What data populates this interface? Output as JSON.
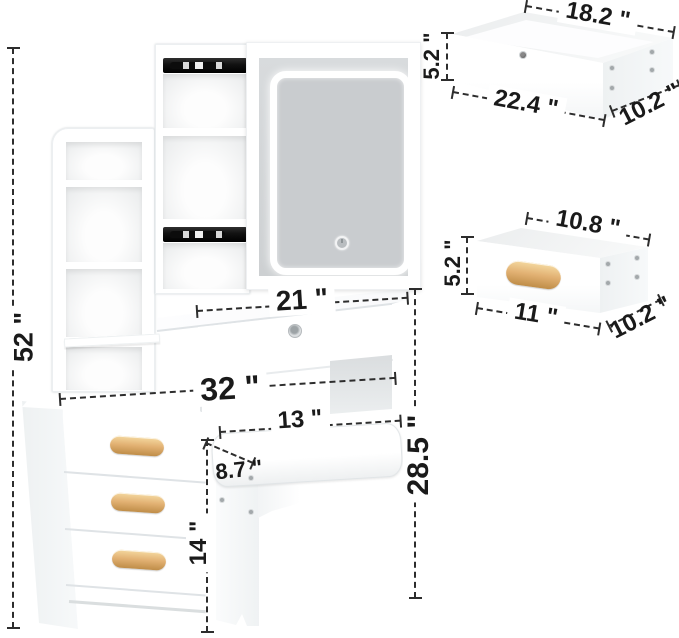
{
  "diagram": {
    "title": "vanity-set-dimension-diagram",
    "accent_colors": {
      "wood_handle": "#e2b173",
      "slide_rail": "#161616",
      "dimension_line": "#2d2d2d",
      "mirror_glass": "#c9cccf",
      "led_ring": "#ffffff"
    },
    "main_unit": {
      "total_height": "52 \"",
      "desktop_width": "21 \"",
      "overall_width": "32 \"",
      "desk_height": "28.5 \""
    },
    "stool": {
      "seat_width": "13 \"",
      "seat_depth": "8.7 \"",
      "height": "14 \""
    },
    "large_drawer": {
      "inner_width": "18.2 \"",
      "height": "5.2 \"",
      "outer_width": "22.4 \"",
      "depth": "10.2 \""
    },
    "small_drawer": {
      "inner_width": "10.8 \"",
      "height": "5.2 \"",
      "outer_width": "11 \"",
      "depth": "10.2 \""
    }
  }
}
